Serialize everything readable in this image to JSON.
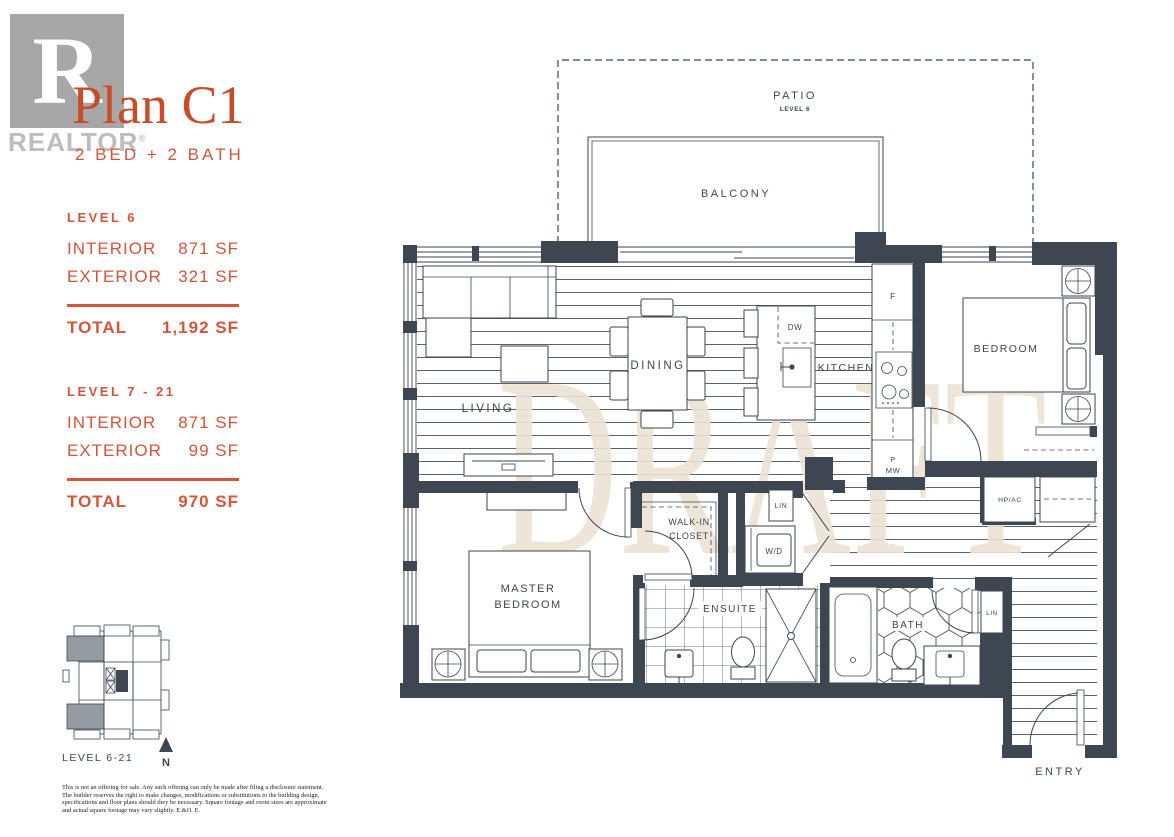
{
  "header": {
    "logo_letter": "R",
    "logo_text": "REALTOR",
    "logo_reg": "®",
    "title": "Plan C1",
    "subtitle": "2 BED + 2 BATH"
  },
  "stats": {
    "blocks": [
      {
        "level": "LEVEL 6",
        "rows": [
          {
            "label": "INTERIOR",
            "value": "871 SF"
          },
          {
            "label": "EXTERIOR",
            "value": "321 SF"
          }
        ],
        "total_label": "TOTAL",
        "total_value": "1,192 SF"
      },
      {
        "level": "LEVEL 7 - 21",
        "rows": [
          {
            "label": "INTERIOR",
            "value": "871 SF"
          },
          {
            "label": "EXTERIOR",
            "value": "99 SF"
          }
        ],
        "total_label": "TOTAL",
        "total_value": "970 SF"
      }
    ]
  },
  "keyplan": {
    "caption": "LEVEL 6-21",
    "north": "N"
  },
  "disclaimer": {
    "lines": [
      "This is not an offering for sale. Any such offering can only be made after filing a disclosure statement.",
      "The builder reserves the right to make changes, modifications or substitutions to the building design,",
      "specifications and floor plans should they be necessary. Square footage and room sizes are approximate",
      "and actual square footage may vary slightly. E.&O. E."
    ]
  },
  "floorplan": {
    "watermark": "DRAFT",
    "labels": {
      "patio": "PATIO",
      "patio_level": "LEVEL 6",
      "balcony": "BALCONY",
      "living": "LIVING",
      "dining": "DINING",
      "kitchen": "KITCHEN",
      "bedroom": "BEDROOM",
      "master_line1": "MASTER",
      "master_line2": "BEDROOM",
      "walkin_line1": "WALK-IN",
      "walkin_line2": "CLOSET",
      "ensuite": "ENSUITE",
      "bath": "BATH",
      "entry": "ENTRY",
      "wd": "W/D",
      "lin_hall": "LIN",
      "lin_bath": "LIN",
      "hpac": "HP/AC",
      "fridge": "F",
      "dishwasher": "DW",
      "pantry_line1": "P",
      "pantry_line2": "MW"
    },
    "colors": {
      "accent": "#d4553a",
      "wall": "#3d4651",
      "watermark": "#ece4d4",
      "keyplan_gray": "#969ba2",
      "logo_gray": "#a7a7a7"
    }
  }
}
